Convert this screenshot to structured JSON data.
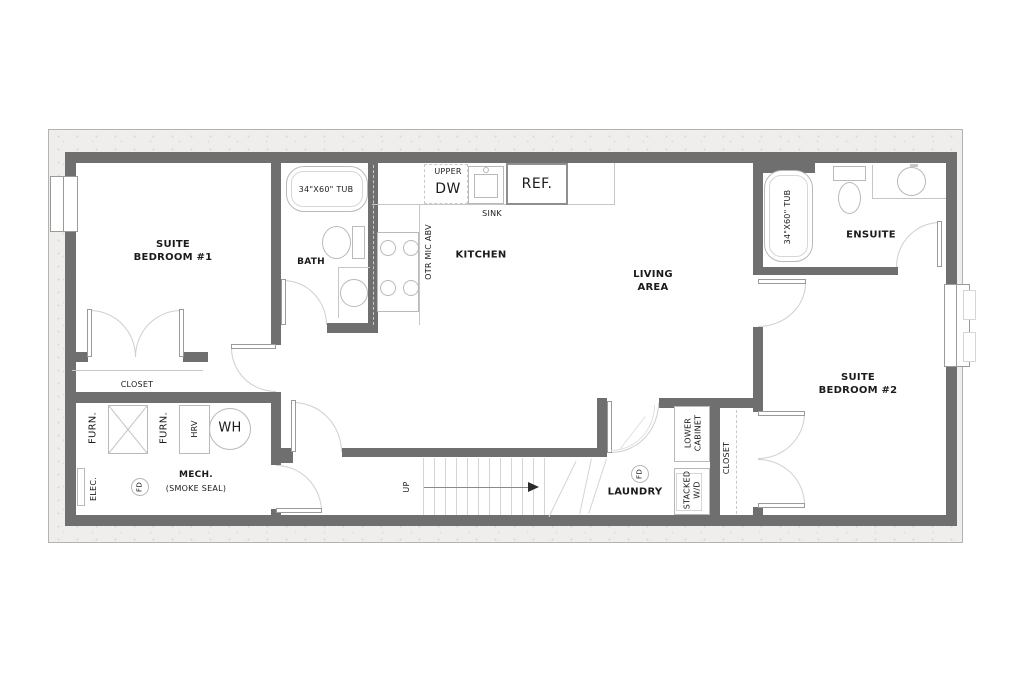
{
  "colors": {
    "wall": "#6f6f6f",
    "band": "#efeeec",
    "line": "#c6c6c6",
    "fixture": "#b9b9b9",
    "arc": "#cfcfcf",
    "stair": "#d4d4d4",
    "dash": "#c9c9c9",
    "ink": "#1b1b1b"
  },
  "plan": {
    "rooms": {
      "bedroom1": {
        "label": "SUITE\nBEDROOM #1",
        "closet": "CLOSET"
      },
      "bath": {
        "label": "BATH",
        "tub": "34\"X60\" TUB"
      },
      "kitchen": {
        "label": "KITCHEN",
        "upper": "UPPER",
        "dishwasher": "DW",
        "sink": "SINK",
        "fridge": "REF.",
        "otr_mic": "OTR MIC ABV"
      },
      "living": {
        "label": "LIVING\nAREA"
      },
      "ensuite": {
        "label": "ENSUITE",
        "tub": "34\"X60\" TUB"
      },
      "bedroom2": {
        "label": "SUITE\nBEDROOM #2",
        "closet": "CLOSET"
      },
      "mech": {
        "label": "MECH.",
        "sublabel": "(SMOKE SEAL)",
        "furnace1": "FURN.",
        "furnace2": "FURN.",
        "hrv": "HRV",
        "water_heater": "WH",
        "electrical": "ELEC.",
        "floor_drain": "FD"
      },
      "laundry": {
        "label": "LAUNDRY",
        "floor_drain": "FD",
        "lower_cabinet": "LOWER\nCABINET",
        "stacked_wd": "STACKED\nW/D"
      },
      "stairs": {
        "direction": "UP"
      }
    }
  }
}
